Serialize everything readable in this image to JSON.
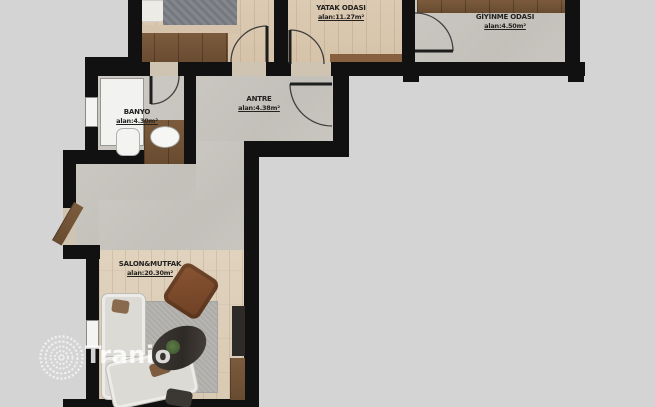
{
  "watermark": {
    "brand": "Tranio"
  },
  "rooms": {
    "yatak": {
      "name": "YATAK ODASI",
      "area": "alan:11.27m²"
    },
    "giyinme": {
      "name": "GİYİNME ODASI",
      "area": "alan:4.50m²"
    },
    "banyo": {
      "name": "BANYO",
      "area": "alan:4.30m²"
    },
    "antre": {
      "name": "ANTRE",
      "area": "alan:4.38m²"
    },
    "salon": {
      "name": "SALON&MUTFAK",
      "area": "alan:20.30m²"
    }
  },
  "colors": {
    "background": "#d4d4d4",
    "wall": "#111111",
    "wood_floor": "#d8c7b0",
    "concrete_floor": "#c7c4be",
    "dark_wood": "#6e4f33",
    "label_text": "#24221f",
    "watermark": "#ffffff"
  }
}
